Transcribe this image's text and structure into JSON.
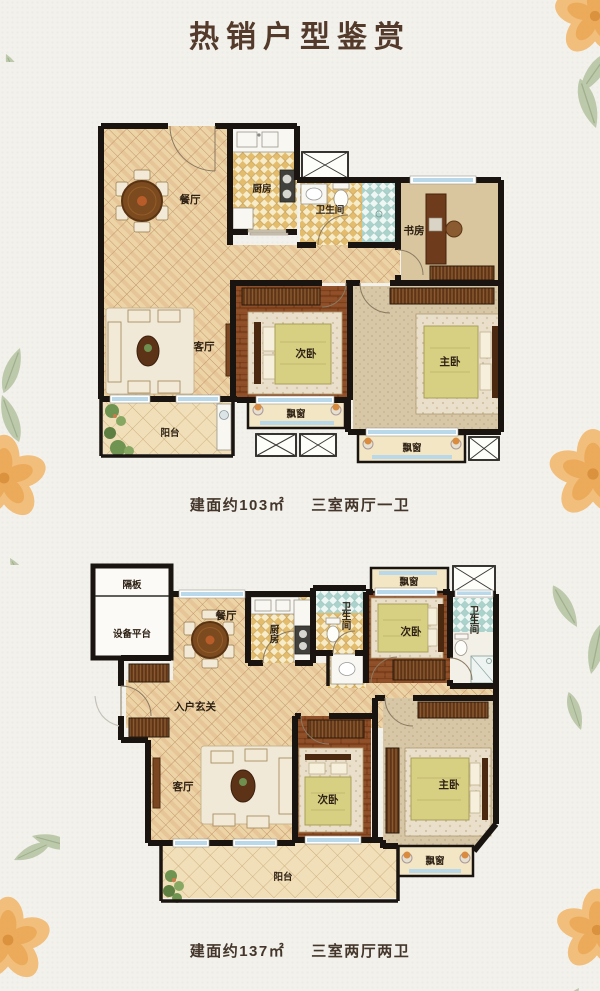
{
  "page": {
    "title": "热销户型鉴赏"
  },
  "plan1": {
    "area": "建面约103㎡",
    "layout": "三室两厅一卫",
    "rooms": {
      "dining": "餐厅",
      "kitchen": "厨房",
      "bathroom": "卫生间",
      "study": "书房",
      "living": "客厅",
      "bedroom2": "次卧",
      "master": "主卧",
      "balcony": "阳台",
      "baywindow1": "飘窗",
      "baywindow2": "飘窗"
    }
  },
  "plan2": {
    "area": "建面约137㎡",
    "layout": "三室两厅两卫",
    "rooms": {
      "partition": "隔板",
      "equipment": "设备平台",
      "dining": "餐厅",
      "kitchen": "厨房",
      "bathroom1": "卫生间",
      "baywindow_top": "飘窗",
      "bedroom2_top": "次卧",
      "bathroom2": "卫生间",
      "entry": "入户玄关",
      "living": "客厅",
      "bedroom2_bottom": "次卧",
      "master": "主卧",
      "balcony": "阳台",
      "baywindow_bottom": "飘窗"
    }
  },
  "colors": {
    "background": "#f2f1ec",
    "title": "#533a2b",
    "caption": "#44362a",
    "wall": "#1a1410",
    "floor_tile": "#ecd4a7",
    "wood_floor": "#8d4d26",
    "kitchen_checker": "#e3bd6d",
    "bath_teal": "#abd3cc",
    "window_glass": "#b9d8e9",
    "bedding": "#d7d083",
    "flower": "#f2b464",
    "leaf": "#b9c6a6"
  }
}
